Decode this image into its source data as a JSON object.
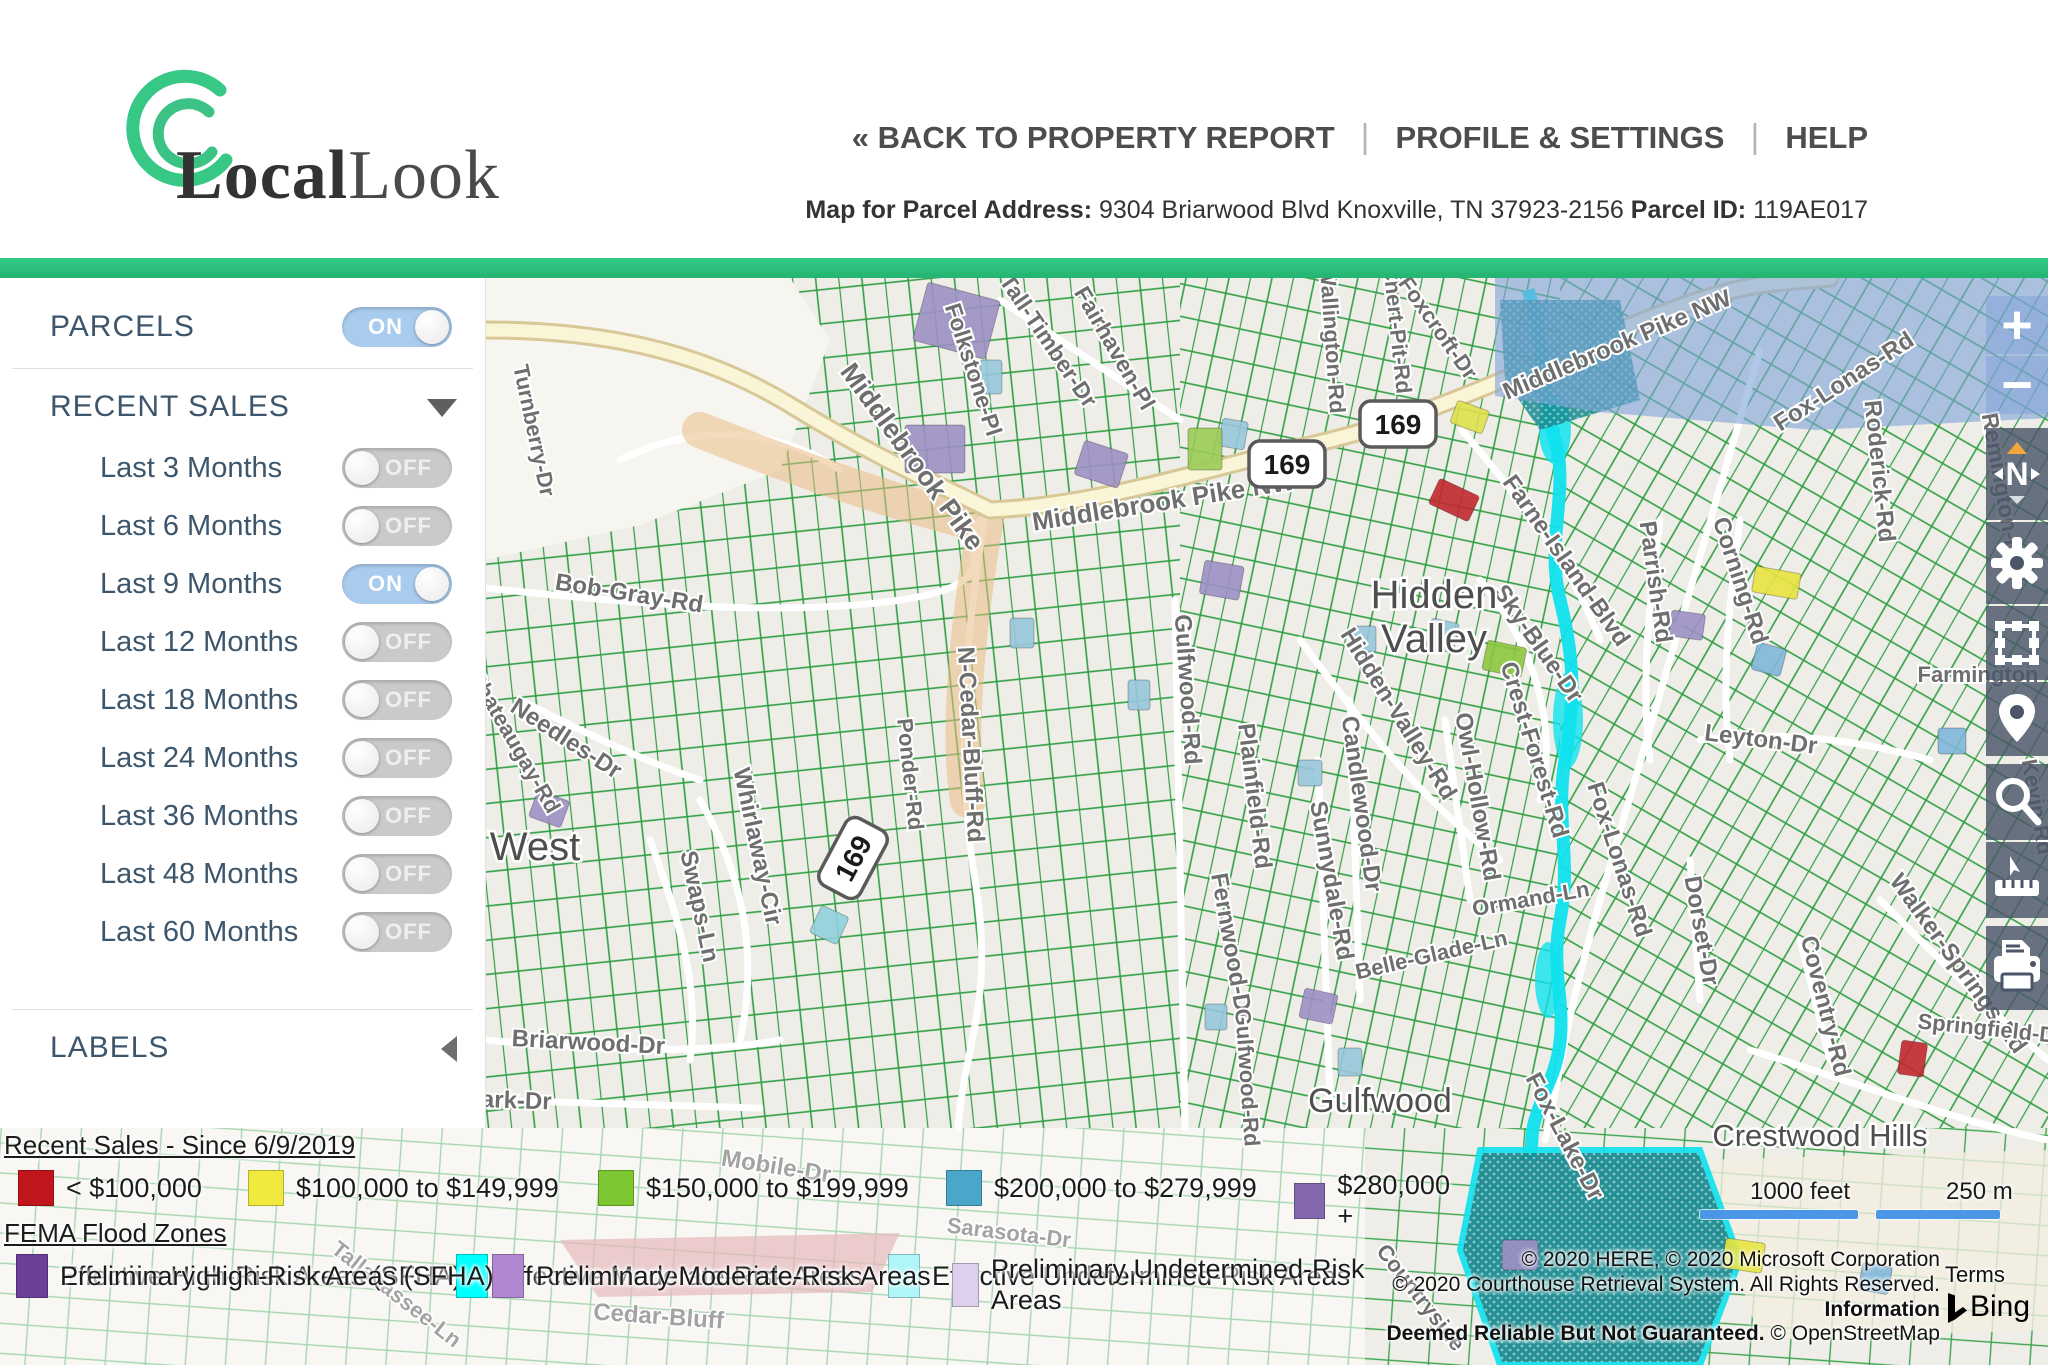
{
  "header": {
    "brand_bold": "Local",
    "brand_light": "Look",
    "nav": {
      "back": "« BACK TO PROPERTY REPORT",
      "profile": "PROFILE & SETTINGS",
      "help": "HELP",
      "separator": "|"
    },
    "subtitle": {
      "address_label": "Map for Parcel Address:",
      "address": " 9304 Briarwood Blvd Knoxville, TN 37923-2156 ",
      "parcel_label": "Parcel ID:",
      "parcel_id": " 119AE017"
    }
  },
  "sidebar": {
    "parcels": {
      "label": "PARCELS",
      "state": "ON"
    },
    "recent_sales": {
      "label": "RECENT SALES",
      "items": [
        {
          "label": "Last 3 Months",
          "state": "OFF"
        },
        {
          "label": "Last 6 Months",
          "state": "OFF"
        },
        {
          "label": "Last 9 Months",
          "state": "ON"
        },
        {
          "label": "Last 12 Months",
          "state": "OFF"
        },
        {
          "label": "Last 18 Months",
          "state": "OFF"
        },
        {
          "label": "Last 24 Months",
          "state": "OFF"
        },
        {
          "label": "Last 36 Months",
          "state": "OFF"
        },
        {
          "label": "Last 48 Months",
          "state": "OFF"
        },
        {
          "label": "Last 60 Months",
          "state": "OFF"
        }
      ]
    },
    "labels_section": {
      "label": "LABELS"
    }
  },
  "toolbar": {
    "zoom_in_glyph": "+",
    "zoom_out_glyph": "−",
    "compass_letter": "N",
    "icons": [
      "zoom-in",
      "zoom-out",
      "compass",
      "settings-gear",
      "select-area",
      "location-pin",
      "search-magnifier",
      "measure-ruler",
      "print"
    ]
  },
  "legend": {
    "recent_sales": {
      "title": "Recent Sales - Since 6/9/2019",
      "items": [
        {
          "label": "< $100,000",
          "color": "#c0161c",
          "x": 18
        },
        {
          "label": "$100,000 to $149,999",
          "color": "#f2e93e",
          "x": 248
        },
        {
          "label": "$150,000 to $199,999",
          "color": "#7dc832",
          "x": 598
        },
        {
          "label": "$200,000 to $279,999",
          "color": "#4ba7c9",
          "x": 946
        },
        {
          "label": "$280,000 +",
          "color": "#8468ad",
          "x": 1294
        }
      ]
    },
    "fema": {
      "title": "FEMA Flood Zones",
      "row1": [
        {
          "label": "Effective High-Risk Areas (SFHA)",
          "color": "#0f8585",
          "x": 16
        },
        {
          "label": "Effective Moderate-Risk Areas",
          "color": "#00ffff",
          "x": 456
        },
        {
          "label": "Effective Undetermined-Risk Areas",
          "color": "#aef6f8",
          "x": 888
        },
        {
          "label": "Preliminary High-Risk Areas (SFHA)",
          "color": "#6e3f99",
          "x": 16
        },
        {
          "label": "Preliminary Moderate-Risk Areas",
          "color": "#b287d2",
          "x": 492
        },
        {
          "label": "Preliminary Undetermined-Risk Areas",
          "color": "#ded0ec",
          "x": 952
        }
      ]
    }
  },
  "map": {
    "scale": {
      "feet": "1000 feet",
      "meters": "250 m"
    },
    "attribution": {
      "line1": "© 2020 HERE, © 2020 Microsoft Corporation",
      "line2_normal": "© 2020 Courthouse Retrieval System. All Rights Reserved. ",
      "line2_bold": "Information",
      "line3_bold": "Deemed Reliable But Not Guaranteed.",
      "line3_normal": " © OpenStreetMap",
      "terms": "Terms",
      "bing": "Bing"
    },
    "shield_text": "169",
    "shields": [
      {
        "x": 1398,
        "y": 424,
        "r": 0
      },
      {
        "x": 1287,
        "y": 464,
        "r": 0
      },
      {
        "x": 853,
        "y": 858,
        "r": -62
      }
    ],
    "place_labels": [
      {
        "t": "Hidden",
        "x": 1434,
        "y": 608,
        "s": 40
      },
      {
        "t": "Valley",
        "x": 1434,
        "y": 652,
        "s": 40
      },
      {
        "t": "West",
        "x": 535,
        "y": 860,
        "s": 40
      },
      {
        "t": "Gulfwood",
        "x": 1380,
        "y": 1112,
        "s": 34
      },
      {
        "t": "Crestwood Hills",
        "x": 1820,
        "y": 1146,
        "s": 31
      }
    ],
    "road_labels": [
      {
        "t": "Middlebrook Pike",
        "x": 905,
        "y": 462,
        "r": 54,
        "s": 27
      },
      {
        "t": "Middlebrook Pike NW",
        "x": 1165,
        "y": 510,
        "r": -9,
        "s": 26
      },
      {
        "t": "Middlebrook Pike NW",
        "x": 1620,
        "y": 352,
        "r": -23,
        "s": 24
      },
      {
        "t": "Bob-Gray-Rd",
        "x": 628,
        "y": 601,
        "r": 9,
        "s": 24
      },
      {
        "t": "N-Cedar-Bluff-Rd",
        "x": 963,
        "y": 745,
        "r": 87,
        "s": 24
      },
      {
        "t": "Ponder-Rd",
        "x": 903,
        "y": 775,
        "r": 84,
        "s": 22
      },
      {
        "t": "Turnberry-Dr",
        "x": 527,
        "y": 432,
        "r": 78,
        "s": 22
      },
      {
        "t": "Folkstone-Pl",
        "x": 966,
        "y": 372,
        "r": 72,
        "s": 23
      },
      {
        "t": "Tall-Timber-Dr",
        "x": 1042,
        "y": 345,
        "r": 56,
        "s": 23
      },
      {
        "t": "Fairhaven-Pl",
        "x": 1108,
        "y": 352,
        "r": 60,
        "s": 23
      },
      {
        "t": "Chert-Pit-Rd",
        "x": 1390,
        "y": 330,
        "r": 84,
        "s": 22
      },
      {
        "t": "Foxcroft-Dr",
        "x": 1432,
        "y": 332,
        "r": 55,
        "s": 22
      },
      {
        "t": "Wallington-Rd",
        "x": 1325,
        "y": 340,
        "r": 86,
        "s": 22
      },
      {
        "t": "Farne-Island-Blvd",
        "x": 1560,
        "y": 565,
        "r": 55,
        "s": 24
      },
      {
        "t": "Sky-Blue-Dr",
        "x": 1532,
        "y": 648,
        "r": 55,
        "s": 24
      },
      {
        "t": "Crest-Forest-Rd",
        "x": 1527,
        "y": 752,
        "r": 73,
        "s": 24
      },
      {
        "t": "Parrish-Rd",
        "x": 1648,
        "y": 583,
        "r": 82,
        "s": 24
      },
      {
        "t": "Corning-Rd",
        "x": 1733,
        "y": 583,
        "r": 72,
        "s": 24
      },
      {
        "t": "Roderick-Rd",
        "x": 1872,
        "y": 472,
        "r": 84,
        "s": 24
      },
      {
        "t": "Fox-Lonas-Rd",
        "x": 1848,
        "y": 388,
        "r": -33,
        "s": 24
      },
      {
        "t": "Remington-Dr",
        "x": 1995,
        "y": 490,
        "r": 80,
        "s": 23
      },
      {
        "t": "Hidden-Valley-Rd",
        "x": 1392,
        "y": 718,
        "r": 58,
        "s": 24
      },
      {
        "t": "Owl-Hollow-Rd",
        "x": 1470,
        "y": 798,
        "r": 80,
        "s": 24
      },
      {
        "t": "Candlewood-Dr",
        "x": 1354,
        "y": 805,
        "r": 82,
        "s": 24
      },
      {
        "t": "Gulfwood-Rd",
        "x": 1180,
        "y": 690,
        "r": 86,
        "s": 24
      },
      {
        "t": "Sunnydale-Rd",
        "x": 1324,
        "y": 882,
        "r": 80,
        "s": 24
      },
      {
        "t": "Plainfield-Rd",
        "x": 1247,
        "y": 797,
        "r": 83,
        "s": 24
      },
      {
        "t": "Fernwood-Dr",
        "x": 1224,
        "y": 948,
        "r": 80,
        "s": 24
      },
      {
        "t": "Gulfwood-Rd",
        "x": 1240,
        "y": 1078,
        "r": 86,
        "s": 22
      },
      {
        "t": "Fox-Lonas-Rd",
        "x": 1612,
        "y": 862,
        "r": 72,
        "s": 24
      },
      {
        "t": "Ormand-Ln",
        "x": 1532,
        "y": 906,
        "r": -10,
        "s": 22
      },
      {
        "t": "Belle-Glade-Ln",
        "x": 1433,
        "y": 962,
        "r": -13,
        "s": 22
      },
      {
        "t": "Leyton-Dr",
        "x": 1760,
        "y": 747,
        "r": 7,
        "s": 24
      },
      {
        "t": "Dorset-Dr",
        "x": 1694,
        "y": 932,
        "r": 80,
        "s": 24
      },
      {
        "t": "Coventry-Rd",
        "x": 1818,
        "y": 1008,
        "r": 76,
        "s": 24
      },
      {
        "t": "Walker-Springs-Rd",
        "x": 1952,
        "y": 968,
        "r": 54,
        "s": 24
      },
      {
        "t": "Whirlaway-Cir",
        "x": 750,
        "y": 848,
        "r": 78,
        "s": 24
      },
      {
        "t": "Swaps-Ln",
        "x": 692,
        "y": 908,
        "r": 78,
        "s": 24
      },
      {
        "t": "Needles-Dr",
        "x": 562,
        "y": 745,
        "r": 33,
        "s": 24
      },
      {
        "t": "Chateaugay-Rd",
        "x": 508,
        "y": 745,
        "r": 60,
        "s": 22
      },
      {
        "t": "Briarwood-Dr",
        "x": 588,
        "y": 1050,
        "r": 3,
        "s": 24
      },
      {
        "t": "Park-Dr",
        "x": 508,
        "y": 1108,
        "r": 2,
        "s": 24
      },
      {
        "t": "Fox-Lake-Dr",
        "x": 1558,
        "y": 1140,
        "r": 62,
        "s": 24
      },
      {
        "t": "Kevin-Rd",
        "x": 2030,
        "y": 808,
        "r": 80,
        "s": 22
      },
      {
        "t": "Springfield-Dr",
        "x": 1990,
        "y": 1036,
        "r": 6,
        "s": 22
      },
      {
        "t": "Farmington",
        "x": 1978,
        "y": 682,
        "r": 0,
        "s": 22
      },
      {
        "t": "Mobile-Dr",
        "x": 775,
        "y": 1174,
        "r": 9,
        "s": 24,
        "f": 1
      },
      {
        "t": "Sarasota-Dr",
        "x": 1008,
        "y": 1240,
        "r": 7,
        "s": 22,
        "f": 1
      },
      {
        "t": "Tallahassee-Ln",
        "x": 392,
        "y": 1300,
        "r": 38,
        "s": 22,
        "f": 1
      },
      {
        "t": "Cedar-Bluff",
        "x": 658,
        "y": 1324,
        "r": 4,
        "s": 24,
        "f": 1
      },
      {
        "t": "Countryside",
        "x": 1415,
        "y": 1302,
        "r": 52,
        "s": 22
      }
    ],
    "sale_parcels": [
      {
        "x": 928,
        "y": 282,
        "w": 75,
        "h": 60,
        "r": 15,
        "c": "#9c8fc4"
      },
      {
        "x": 905,
        "y": 425,
        "w": 60,
        "h": 48,
        "r": 0,
        "c": "#9c8fc4"
      },
      {
        "x": 1085,
        "y": 440,
        "w": 46,
        "h": 36,
        "r": 18,
        "c": "#9c8fc4"
      },
      {
        "x": 1205,
        "y": 560,
        "w": 40,
        "h": 34,
        "r": 10,
        "c": "#9c8fc4"
      },
      {
        "x": 1672,
        "y": 610,
        "w": 34,
        "h": 26,
        "r": 8,
        "c": "#9c8fc4"
      },
      {
        "x": 1305,
        "y": 988,
        "w": 34,
        "h": 30,
        "r": 12,
        "c": "#9c8fc4"
      },
      {
        "x": 1502,
        "y": 1240,
        "w": 36,
        "h": 30,
        "r": 0,
        "c": "#9c8fc4"
      },
      {
        "x": 538,
        "y": 790,
        "w": 34,
        "h": 28,
        "r": 20,
        "c": "#9c8fc4"
      },
      {
        "x": 980,
        "y": 360,
        "w": 22,
        "h": 34,
        "r": 0,
        "c": "#97c6db"
      },
      {
        "x": 1223,
        "y": 418,
        "w": 26,
        "h": 28,
        "r": 10,
        "c": "#97c6db"
      },
      {
        "x": 1432,
        "y": 618,
        "w": 28,
        "h": 30,
        "r": 12,
        "c": "#97c6db"
      },
      {
        "x": 1352,
        "y": 626,
        "w": 24,
        "h": 26,
        "r": 0,
        "c": "#97c6db"
      },
      {
        "x": 1758,
        "y": 642,
        "w": 30,
        "h": 28,
        "r": 15,
        "c": "#7fb6d9"
      },
      {
        "x": 1938,
        "y": 728,
        "w": 28,
        "h": 26,
        "r": 0,
        "c": "#7fb6d9"
      },
      {
        "x": 1010,
        "y": 618,
        "w": 24,
        "h": 30,
        "r": 0,
        "c": "#97c6db"
      },
      {
        "x": 1128,
        "y": 680,
        "w": 22,
        "h": 30,
        "r": 0,
        "c": "#97c6db"
      },
      {
        "x": 1298,
        "y": 760,
        "w": 24,
        "h": 26,
        "r": 0,
        "c": "#97c6db"
      },
      {
        "x": 822,
        "y": 905,
        "w": 30,
        "h": 30,
        "r": 25,
        "c": "#8fd0dc"
      },
      {
        "x": 1338,
        "y": 1048,
        "w": 24,
        "h": 28,
        "r": 0,
        "c": "#97c6db"
      },
      {
        "x": 1205,
        "y": 1004,
        "w": 22,
        "h": 26,
        "r": 0,
        "c": "#97c6db"
      },
      {
        "x": 1863,
        "y": 1262,
        "w": 30,
        "h": 28,
        "r": 10,
        "c": "#7fb6d9"
      },
      {
        "x": 1488,
        "y": 640,
        "w": 40,
        "h": 30,
        "r": 12,
        "c": "#8cc63e"
      },
      {
        "x": 1188,
        "y": 428,
        "w": 34,
        "h": 42,
        "r": 0,
        "c": "#9bcb57"
      },
      {
        "x": 1756,
        "y": 566,
        "w": 46,
        "h": 26,
        "r": 10,
        "c": "#e8e33f"
      },
      {
        "x": 1458,
        "y": 400,
        "w": 34,
        "h": 24,
        "r": 20,
        "c": "#dde04a"
      },
      {
        "x": 1726,
        "y": 1238,
        "w": 40,
        "h": 30,
        "r": 8,
        "c": "#e8e33f"
      },
      {
        "x": 1440,
        "y": 478,
        "w": 44,
        "h": 28,
        "r": 25,
        "c": "#c0272d"
      },
      {
        "x": 1902,
        "y": 1040,
        "w": 26,
        "h": 34,
        "r": 8,
        "c": "#c0272d"
      }
    ]
  },
  "colors": {
    "accent_green": "#2ac17c",
    "sidebar_text": "#3d566c",
    "toggle_on": "#a9cbee",
    "toggle_off": "#cacaca",
    "scale_bar": "#4c96e8",
    "flood_stream": "#10e2ee",
    "flood_teal": "#17898f"
  }
}
